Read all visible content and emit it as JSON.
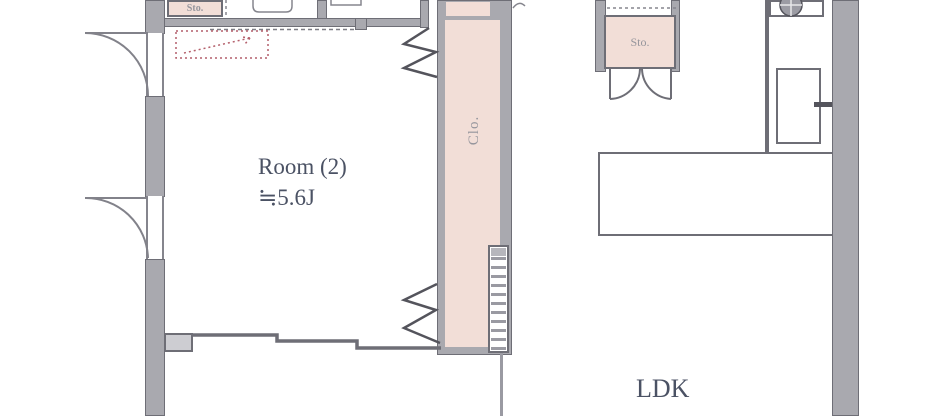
{
  "floorplan": {
    "rooms": {
      "room2": {
        "label": "Room (2)",
        "size": "≒5.6J"
      },
      "ldk": {
        "label": "LDK"
      },
      "closet": {
        "label": "Clo."
      },
      "storage_top_left": {
        "label": "Sto."
      },
      "storage_middle": {
        "label": "Sto."
      }
    },
    "colors": {
      "wall_fill": "#a9a9af",
      "wall_edge": "#6e6e76",
      "closet_fill": "#f2ded7",
      "room_text": "#4b5264",
      "label_text": "#95959c",
      "annotation_red": "#b45f6b"
    }
  }
}
